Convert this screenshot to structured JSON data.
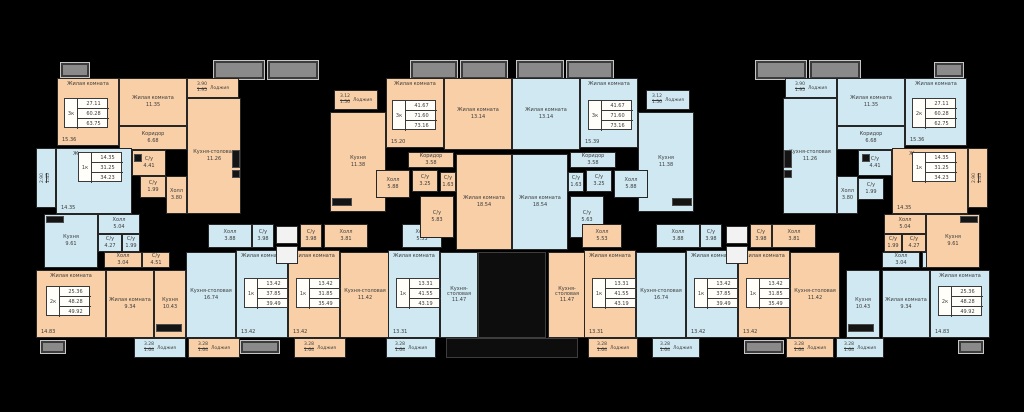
{
  "palette": {
    "bg": "#000000",
    "peach": "#f8cfa6",
    "blue": "#cfe8f2",
    "wall": "#262626",
    "balcony": "#8a8a8a",
    "balcony_border": "#c6c6c6",
    "table_bg": "#fffef9",
    "text": "#3c3c3c",
    "core": "#0d0d0d",
    "stair": "#f2f2f2"
  },
  "labels": {
    "loggia": "Лоджия"
  },
  "rooms": [
    {
      "label": "Жилая комната",
      "area": "15.36",
      "x": 57,
      "y": 78,
      "w": 62,
      "h": 68,
      "f": "p",
      "top": 1
    },
    {
      "label": "Жилая комната",
      "area": "11.35",
      "x": 119,
      "y": 78,
      "w": 68,
      "h": 48,
      "f": "p"
    },
    {
      "label": "Кухня-столовая",
      "area": "11.26",
      "x": 187,
      "y": 98,
      "w": 54,
      "h": 116,
      "f": "p"
    },
    {
      "label": "Коридор",
      "area": "6.68",
      "x": 119,
      "y": 126,
      "w": 68,
      "h": 24,
      "f": "p"
    },
    {
      "label": "С/у",
      "area": "4.41",
      "x": 132,
      "y": 150,
      "w": 34,
      "h": 26,
      "f": "p"
    },
    {
      "label": "С/у",
      "area": "1.99",
      "x": 140,
      "y": 176,
      "w": 26,
      "h": 22,
      "f": "p"
    },
    {
      "label": "Холл",
      "area": "3.80",
      "x": 166,
      "y": 176,
      "w": 21,
      "h": 38,
      "f": "p"
    },
    {
      "label": "Жилая комната",
      "area": "14.35",
      "x": 56,
      "y": 148,
      "w": 76,
      "h": 66,
      "f": "b",
      "top": 1
    },
    {
      "label": "Кухня",
      "area": "9.61",
      "x": 44,
      "y": 214,
      "w": 54,
      "h": 54,
      "f": "b"
    },
    {
      "label": "Холл",
      "area": "5.04",
      "x": 98,
      "y": 214,
      "w": 42,
      "h": 20,
      "f": "b"
    },
    {
      "label": "С/у",
      "area": "4.27",
      "x": 98,
      "y": 234,
      "w": 24,
      "h": 18,
      "f": "b"
    },
    {
      "label": "С/у",
      "area": "1.99",
      "x": 122,
      "y": 234,
      "w": 18,
      "h": 18,
      "f": "b"
    },
    {
      "label": "Жилая комната",
      "area": "14.83",
      "x": 36,
      "y": 270,
      "w": 70,
      "h": 68,
      "f": "p",
      "top": 1
    },
    {
      "label": "Жилая комната",
      "area": "9.34",
      "x": 106,
      "y": 270,
      "w": 48,
      "h": 68,
      "f": "p"
    },
    {
      "label": "Кухня",
      "area": "10.43",
      "x": 154,
      "y": 270,
      "w": 32,
      "h": 68,
      "f": "p"
    },
    {
      "label": "Холл",
      "area": "3.04",
      "x": 104,
      "y": 252,
      "w": 38,
      "h": 16,
      "f": "p"
    },
    {
      "label": "С/у",
      "area": "4.51",
      "x": 142,
      "y": 252,
      "w": 28,
      "h": 16,
      "f": "p"
    },
    {
      "label": "Кухня-столовая",
      "area": "16.74",
      "x": 186,
      "y": 252,
      "w": 50,
      "h": 86,
      "f": "b"
    },
    {
      "label": "Жилая комната",
      "area": "13.42",
      "x": 236,
      "y": 250,
      "w": 52,
      "h": 88,
      "f": "b",
      "top": 1
    },
    {
      "label": "Холл",
      "area": "3.88",
      "x": 208,
      "y": 224,
      "w": 44,
      "h": 24,
      "f": "b"
    },
    {
      "label": "С/у",
      "area": "3.98",
      "x": 252,
      "y": 224,
      "w": 22,
      "h": 24,
      "f": "b"
    },
    {
      "label": "Жилая комната",
      "area": "13.42",
      "x": 288,
      "y": 250,
      "w": 52,
      "h": 88,
      "f": "p",
      "top": 1
    },
    {
      "label": "Кухня-столовая",
      "area": "11.42",
      "x": 340,
      "y": 252,
      "w": 50,
      "h": 86,
      "f": "p"
    },
    {
      "label": "Холл",
      "area": "3.81",
      "x": 324,
      "y": 224,
      "w": 44,
      "h": 24,
      "f": "p"
    },
    {
      "label": "С/у",
      "area": "3.98",
      "x": 300,
      "y": 224,
      "w": 22,
      "h": 24,
      "f": "p"
    },
    {
      "label": "Жилая комната",
      "area": "13.31",
      "x": 388,
      "y": 250,
      "w": 52,
      "h": 88,
      "f": "b",
      "top": 1
    },
    {
      "label": "Кухня-столовая",
      "area": "11.47",
      "x": 440,
      "y": 252,
      "w": 38,
      "h": 86,
      "f": "b"
    },
    {
      "label": "Холл",
      "area": "5.53",
      "x": 402,
      "y": 224,
      "w": 40,
      "h": 24,
      "f": "b"
    },
    {
      "label": "Кухня",
      "area": "11.38",
      "x": 330,
      "y": 112,
      "w": 56,
      "h": 100,
      "f": "p"
    },
    {
      "label": "Жилая комната",
      "area": "15.20",
      "x": 386,
      "y": 78,
      "w": 58,
      "h": 70,
      "f": "p",
      "top": 1
    },
    {
      "label": "Жилая комната",
      "area": "13.14",
      "x": 444,
      "y": 78,
      "w": 68,
      "h": 72,
      "f": "p"
    },
    {
      "label": "Жилая комната",
      "area": "18.54",
      "x": 456,
      "y": 154,
      "w": 56,
      "h": 96,
      "f": "p"
    },
    {
      "label": "Коридор",
      "area": "3.58",
      "x": 408,
      "y": 152,
      "w": 46,
      "h": 16,
      "f": "p"
    },
    {
      "label": "Холл",
      "area": "5.88",
      "x": 376,
      "y": 170,
      "w": 34,
      "h": 28,
      "f": "p"
    },
    {
      "label": "С/у",
      "area": "3.25",
      "x": 412,
      "y": 170,
      "w": 26,
      "h": 22,
      "f": "p"
    },
    {
      "label": "С/у",
      "area": "1.63",
      "x": 440,
      "y": 172,
      "w": 16,
      "h": 20,
      "f": "p"
    },
    {
      "label": "С/у",
      "area": "5.83",
      "x": 420,
      "y": 196,
      "w": 34,
      "h": 42,
      "f": "p"
    },
    {
      "label": "Кухня",
      "area": "11.38",
      "x": 638,
      "y": 112,
      "w": 56,
      "h": 100,
      "f": "b"
    },
    {
      "label": "Жилая комната",
      "area": "15.39",
      "x": 580,
      "y": 78,
      "w": 58,
      "h": 70,
      "f": "b",
      "top": 1
    },
    {
      "label": "Жилая комната",
      "area": "13.14",
      "x": 512,
      "y": 78,
      "w": 68,
      "h": 72,
      "f": "b"
    },
    {
      "label": "Жилая комната",
      "area": "18.54",
      "x": 512,
      "y": 154,
      "w": 56,
      "h": 96,
      "f": "b"
    },
    {
      "label": "Коридор",
      "area": "3.58",
      "x": 570,
      "y": 152,
      "w": 46,
      "h": 16,
      "f": "b"
    },
    {
      "label": "Холл",
      "area": "5.88",
      "x": 614,
      "y": 170,
      "w": 34,
      "h": 28,
      "f": "b"
    },
    {
      "label": "С/у",
      "area": "3.25",
      "x": 586,
      "y": 170,
      "w": 26,
      "h": 22,
      "f": "b"
    },
    {
      "label": "С/у",
      "area": "1.63",
      "x": 568,
      "y": 172,
      "w": 16,
      "h": 20,
      "f": "b"
    },
    {
      "label": "С/у",
      "area": "5.63",
      "x": 570,
      "y": 196,
      "w": 34,
      "h": 42,
      "f": "b"
    },
    {
      "label": "Кухня-столовая",
      "area": "11.47",
      "x": 548,
      "y": 252,
      "w": 38,
      "h": 86,
      "f": "p"
    },
    {
      "label": "Жилая комната",
      "area": "13.31",
      "x": 584,
      "y": 250,
      "w": 52,
      "h": 88,
      "f": "p",
      "top": 1
    },
    {
      "label": "Холл",
      "area": "5.53",
      "x": 582,
      "y": 224,
      "w": 40,
      "h": 24,
      "f": "p"
    },
    {
      "label": "Кухня-столовая",
      "area": "16.74",
      "x": 636,
      "y": 252,
      "w": 50,
      "h": 86,
      "f": "b"
    },
    {
      "label": "Жилая комната",
      "area": "13.42",
      "x": 686,
      "y": 250,
      "w": 52,
      "h": 88,
      "f": "b",
      "top": 1
    },
    {
      "label": "Холл",
      "area": "3.88",
      "x": 656,
      "y": 224,
      "w": 44,
      "h": 24,
      "f": "b"
    },
    {
      "label": "С/у",
      "area": "3.98",
      "x": 700,
      "y": 224,
      "w": 22,
      "h": 24,
      "f": "b"
    },
    {
      "label": "Жилая комната",
      "area": "13.42",
      "x": 738,
      "y": 250,
      "w": 52,
      "h": 88,
      "f": "p",
      "top": 1
    },
    {
      "label": "Кухня-столовая",
      "area": "11.42",
      "x": 790,
      "y": 252,
      "w": 50,
      "h": 86,
      "f": "p"
    },
    {
      "label": "Холл",
      "area": "3.81",
      "x": 772,
      "y": 224,
      "w": 44,
      "h": 24,
      "f": "p"
    },
    {
      "label": "С/у",
      "area": "3.98",
      "x": 750,
      "y": 224,
      "w": 22,
      "h": 24,
      "f": "p"
    },
    {
      "label": "Кухня",
      "area": "10.43",
      "x": 846,
      "y": 270,
      "w": 34,
      "h": 68,
      "f": "b"
    },
    {
      "label": "Жилая комната",
      "area": "9.34",
      "x": 882,
      "y": 270,
      "w": 48,
      "h": 68,
      "f": "b"
    },
    {
      "label": "Жилая комната",
      "area": "14.83",
      "x": 930,
      "y": 270,
      "w": 60,
      "h": 68,
      "f": "b",
      "top": 1
    },
    {
      "label": "Холл",
      "area": "3.04",
      "x": 882,
      "y": 252,
      "w": 38,
      "h": 16,
      "f": "b"
    },
    {
      "label": "С/у",
      "area": "4.51",
      "x": 922,
      "y": 252,
      "w": 28,
      "h": 16,
      "f": "b"
    },
    {
      "label": "Жилая комната",
      "area": "15.36",
      "x": 905,
      "y": 78,
      "w": 62,
      "h": 68,
      "f": "b",
      "top": 1
    },
    {
      "label": "Жилая комната",
      "area": "11.35",
      "x": 837,
      "y": 78,
      "w": 68,
      "h": 48,
      "f": "b"
    },
    {
      "label": "Кухня-столовая",
      "area": "11.26",
      "x": 783,
      "y": 98,
      "w": 54,
      "h": 116,
      "f": "b"
    },
    {
      "label": "Коридор",
      "area": "6.68",
      "x": 837,
      "y": 126,
      "w": 68,
      "h": 24,
      "f": "b"
    },
    {
      "label": "С/у",
      "area": "4.41",
      "x": 858,
      "y": 150,
      "w": 34,
      "h": 26,
      "f": "b"
    },
    {
      "label": "С/у",
      "area": "1.99",
      "x": 858,
      "y": 178,
      "w": 26,
      "h": 22,
      "f": "b"
    },
    {
      "label": "Холл",
      "area": "3.80",
      "x": 837,
      "y": 176,
      "w": 21,
      "h": 38,
      "f": "b"
    },
    {
      "label": "Жилая комната",
      "area": "14.35",
      "x": 892,
      "y": 148,
      "w": 76,
      "h": 66,
      "f": "p",
      "top": 1
    },
    {
      "label": "Кухня",
      "area": "9.61",
      "x": 926,
      "y": 214,
      "w": 54,
      "h": 54,
      "f": "p"
    },
    {
      "label": "Холл",
      "area": "5.04",
      "x": 884,
      "y": 214,
      "w": 42,
      "h": 20,
      "f": "p"
    },
    {
      "label": "С/у",
      "area": "4.27",
      "x": 902,
      "y": 234,
      "w": 24,
      "h": 18,
      "f": "p"
    },
    {
      "label": "С/у",
      "area": "1.99",
      "x": 884,
      "y": 234,
      "w": 18,
      "h": 18,
      "f": "p"
    }
  ],
  "tables": [
    {
      "type": "3к",
      "v1": "27.11",
      "v2": "60.28",
      "v3": "63.75",
      "x": 64,
      "y": 98
    },
    {
      "type": "1к",
      "v1": "14.35",
      "v2": "31.25",
      "v3": "34.23",
      "x": 78,
      "y": 152
    },
    {
      "type": "2к",
      "v1": "25.36",
      "v2": "48.28",
      "v3": "49.92",
      "x": 46,
      "y": 286
    },
    {
      "type": "1к",
      "v1": "13.42",
      "v2": "37.85",
      "v3": "39.49",
      "x": 244,
      "y": 278
    },
    {
      "type": "1к",
      "v1": "13.42",
      "v2": "31.85",
      "v3": "35.49",
      "x": 296,
      "y": 278
    },
    {
      "type": "1к",
      "v1": "13.31",
      "v2": "41.55",
      "v3": "43.19",
      "x": 396,
      "y": 278
    },
    {
      "type": "3к",
      "v1": "41.67",
      "v2": "71.60",
      "v3": "73.16",
      "x": 392,
      "y": 100
    },
    {
      "type": "3к",
      "v1": "41.67",
      "v2": "71.60",
      "v3": "73.16",
      "x": 588,
      "y": 100
    },
    {
      "type": "1к",
      "v1": "13.31",
      "v2": "41.55",
      "v3": "43.19",
      "x": 592,
      "y": 278
    },
    {
      "type": "1к",
      "v1": "13.42",
      "v2": "37.85",
      "v3": "39.49",
      "x": 694,
      "y": 278
    },
    {
      "type": "1к",
      "v1": "13.42",
      "v2": "31.85",
      "v3": "35.49",
      "x": 746,
      "y": 278
    },
    {
      "type": "2к",
      "v1": "25.36",
      "v2": "48.28",
      "v3": "49.92",
      "x": 938,
      "y": 286
    },
    {
      "type": "2к",
      "v1": "27.11",
      "v2": "60.28",
      "v3": "62.75",
      "x": 912,
      "y": 98
    },
    {
      "type": "1к",
      "v1": "14.35",
      "v2": "31.25",
      "v3": "34.23",
      "x": 912,
      "y": 152
    }
  ],
  "loggias": [
    {
      "n": "3.12",
      "d": "1.56",
      "x": 334,
      "y": 90,
      "w": 44,
      "h": 20,
      "f": "p"
    },
    {
      "n": "3.12",
      "d": "1.56",
      "x": 646,
      "y": 90,
      "w": 44,
      "h": 20,
      "f": "b"
    },
    {
      "n": "3.90",
      "d": "1.95",
      "x": 187,
      "y": 78,
      "w": 52,
      "h": 20,
      "f": "p"
    },
    {
      "n": "3.90",
      "d": "1.95",
      "x": 785,
      "y": 78,
      "w": 52,
      "h": 20,
      "f": "b"
    },
    {
      "n": "2.90",
      "d": "1.45",
      "x": 36,
      "y": 148,
      "w": 20,
      "h": 60,
      "f": "b",
      "vert": 1
    },
    {
      "n": "2.90",
      "d": "1.45",
      "x": 968,
      "y": 148,
      "w": 20,
      "h": 60,
      "f": "p",
      "vert": 1
    },
    {
      "n": "3.28",
      "d": "1.64",
      "x": 134,
      "y": 338,
      "w": 52,
      "h": 20,
      "f": "b"
    },
    {
      "n": "3.28",
      "d": "1.64",
      "x": 188,
      "y": 338,
      "w": 52,
      "h": 20,
      "f": "p"
    },
    {
      "n": "3.28",
      "d": "1.64",
      "x": 294,
      "y": 338,
      "w": 52,
      "h": 20,
      "f": "p"
    },
    {
      "n": "3.28",
      "d": "1.64",
      "x": 386,
      "y": 338,
      "w": 50,
      "h": 20,
      "f": "b"
    },
    {
      "n": "3.28",
      "d": "1.64",
      "x": 588,
      "y": 338,
      "w": 50,
      "h": 20,
      "f": "p"
    },
    {
      "n": "3.28",
      "d": "1.64",
      "x": 652,
      "y": 338,
      "w": 48,
      "h": 20,
      "f": "b"
    },
    {
      "n": "3.28",
      "d": "1.64",
      "x": 786,
      "y": 338,
      "w": 48,
      "h": 20,
      "f": "p"
    },
    {
      "n": "3.28",
      "d": "1.64",
      "x": 836,
      "y": 338,
      "w": 48,
      "h": 20,
      "f": "b"
    }
  ],
  "balconies": [
    {
      "x": 60,
      "y": 62,
      "w": 30,
      "h": 16
    },
    {
      "x": 213,
      "y": 60,
      "w": 52,
      "h": 20
    },
    {
      "x": 267,
      "y": 60,
      "w": 52,
      "h": 20
    },
    {
      "x": 410,
      "y": 60,
      "w": 48,
      "h": 20
    },
    {
      "x": 460,
      "y": 60,
      "w": 48,
      "h": 20
    },
    {
      "x": 516,
      "y": 60,
      "w": 48,
      "h": 20
    },
    {
      "x": 566,
      "y": 60,
      "w": 48,
      "h": 20
    },
    {
      "x": 755,
      "y": 60,
      "w": 52,
      "h": 20
    },
    {
      "x": 809,
      "y": 60,
      "w": 52,
      "h": 20
    },
    {
      "x": 934,
      "y": 62,
      "w": 30,
      "h": 16
    },
    {
      "x": 40,
      "y": 340,
      "w": 26,
      "h": 14
    },
    {
      "x": 240,
      "y": 340,
      "w": 40,
      "h": 14
    },
    {
      "x": 744,
      "y": 340,
      "w": 40,
      "h": 14
    },
    {
      "x": 958,
      "y": 340,
      "w": 26,
      "h": 14
    }
  ],
  "cores": [
    {
      "x": 478,
      "y": 252,
      "w": 68,
      "h": 86
    },
    {
      "x": 446,
      "y": 338,
      "w": 132,
      "h": 20
    }
  ],
  "stairs": [
    {
      "x": 276,
      "y": 226,
      "w": 22,
      "h": 18
    },
    {
      "x": 276,
      "y": 246,
      "w": 22,
      "h": 18
    },
    {
      "x": 726,
      "y": 226,
      "w": 22,
      "h": 18
    },
    {
      "x": 726,
      "y": 246,
      "w": 22,
      "h": 18
    }
  ],
  "fixtures": [
    {
      "x": 232,
      "y": 150,
      "w": 8,
      "h": 18
    },
    {
      "x": 232,
      "y": 170,
      "w": 8,
      "h": 8
    },
    {
      "x": 46,
      "y": 216,
      "w": 18,
      "h": 7
    },
    {
      "x": 156,
      "y": 324,
      "w": 26,
      "h": 8
    },
    {
      "x": 332,
      "y": 198,
      "w": 20,
      "h": 8
    },
    {
      "x": 672,
      "y": 198,
      "w": 20,
      "h": 8
    },
    {
      "x": 784,
      "y": 150,
      "w": 8,
      "h": 18
    },
    {
      "x": 784,
      "y": 170,
      "w": 8,
      "h": 8
    },
    {
      "x": 960,
      "y": 216,
      "w": 18,
      "h": 7
    },
    {
      "x": 848,
      "y": 324,
      "w": 26,
      "h": 8
    },
    {
      "x": 134,
      "y": 154,
      "w": 8,
      "h": 8
    },
    {
      "x": 862,
      "y": 154,
      "w": 8,
      "h": 8
    }
  ]
}
